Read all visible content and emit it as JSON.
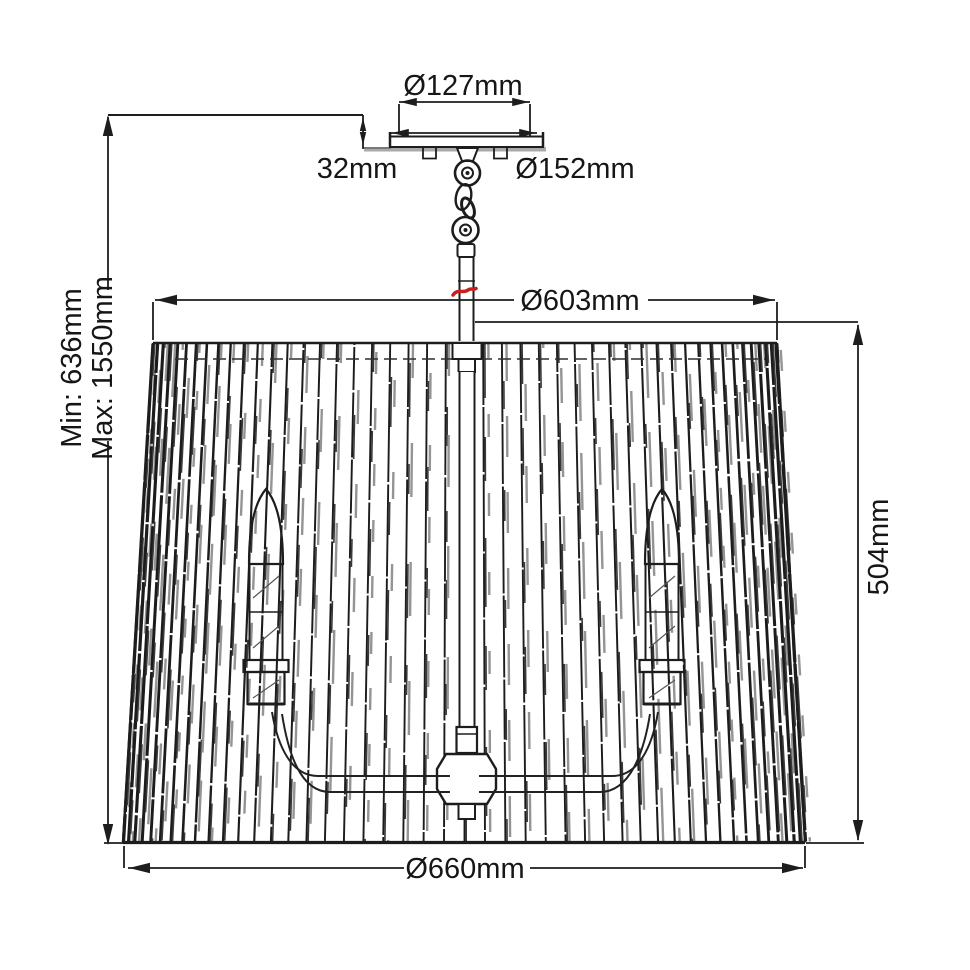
{
  "diagram": {
    "dimensions": {
      "canopy_inner_diameter": "Ø127mm",
      "canopy_depth": "32mm",
      "canopy_diameter": "Ø152mm",
      "shade_top_diameter": "Ø603mm",
      "suspension_min": "Min: 636mm",
      "suspension_max": "Max: 1550mm",
      "shade_height": "504mm",
      "shade_bottom_diameter": "Ø660mm"
    },
    "colors": {
      "line": "#1d1d1d",
      "shade_gray": "#949494",
      "accent_red": "#c81e1e",
      "background": "#ffffff"
    }
  }
}
